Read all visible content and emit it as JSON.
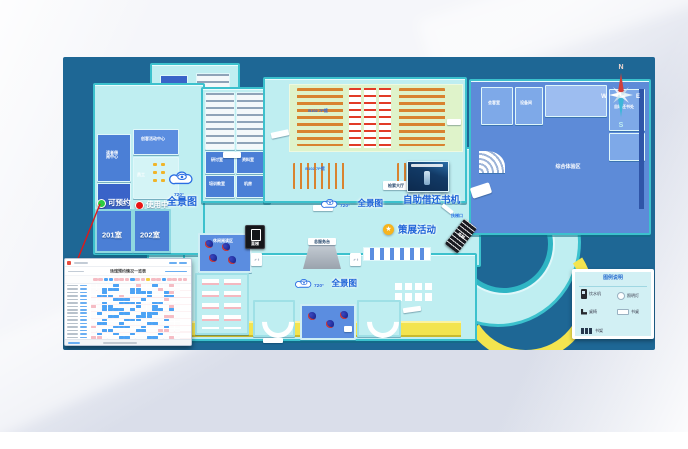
{
  "compass": {
    "n": "N",
    "e": "E",
    "s": "S",
    "w": "W"
  },
  "status": {
    "available": "可预约",
    "in_use": "使用中",
    "room_201": "201室",
    "room_202": "202室"
  },
  "panorama": {
    "degree": "720°",
    "label": "全景图"
  },
  "labels": {
    "self_service": "自助借还书机",
    "exhibition": "策展活动",
    "hall_tag": "B102 7P馆",
    "search_hall": "检索大厅",
    "service_desk": "总服务台",
    "escalator_entry": "扶梯口",
    "escalator": "电梯",
    "elevator": "直梯",
    "restroom": "♂♀"
  },
  "rooms": {
    "reading_center": "读者借阅中心",
    "maker_center": "创客活动中心",
    "staff": "员工",
    "study_1": "研讨室",
    "study_2": "资料室",
    "study_3": "培训教室",
    "study_4": "机房",
    "leisure": "休闲阅读区",
    "guest": "会客室",
    "equipment": "设备间",
    "book_return": "自助还书处",
    "experience_hall": "综合体验区"
  },
  "legend": {
    "title": "图例说明",
    "items": [
      {
        "icon": "water-dispenser-icon",
        "label": "饮水机"
      },
      {
        "icon": "lamp-icon",
        "label": "照明灯"
      },
      {
        "icon": "chair-icon",
        "label": "桌椅"
      },
      {
        "icon": "desk-icon",
        "label": "书桌"
      },
      {
        "icon": "bookshelf-icon",
        "label": "书架"
      }
    ]
  },
  "schedule": {
    "title": "场馆预约情况一览表",
    "tabs": [
      "p",
      "p",
      "b",
      "b",
      "p",
      "p",
      "p",
      "b",
      "p",
      "p",
      "y",
      "p",
      "p",
      "b",
      "p",
      "p",
      "p",
      "p"
    ],
    "grid": [
      "....b...p..b..p.",
      "..bbb..bb...p...",
      "..b....bbbb..bp.",
      ".bbb.p....b..bb.",
      "....bbb..b...p..",
      "..b..bbbb..bb...",
      "p.bb....b..b..p.",
      "..bbbb.b...bb.b.",
      ".b...bb..bbb....",
      "...bb...bbb..pp.",
      "..b...bbb....b..",
      ".bb..b....bb....",
      "p...bbb..b...b..",
      "..bb....bb..pp..",
      ".b..b..b....b...",
      "pp...bb...bb..p."
    ]
  }
}
